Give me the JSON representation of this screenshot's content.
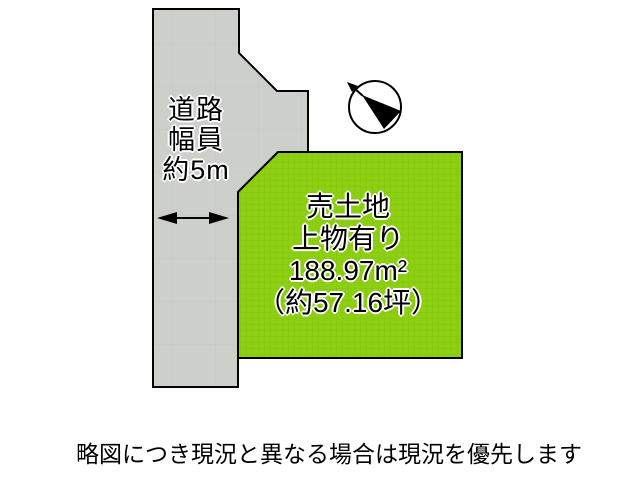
{
  "diagram": {
    "road": {
      "label_lines": [
        "道路",
        "幅員",
        "約5m"
      ],
      "width_arrow_icon": "double-headed-arrow-icon"
    },
    "parcel": {
      "title": "売土地",
      "subtitle": "上物有り",
      "area_sqm": "188.97m²",
      "area_tsubo": "（約57.16坪）"
    },
    "compass_icon": "compass-north-icon",
    "note": "略図につき現況と異なる場合は現況を優先します",
    "colors": {
      "road_fill": "#cdd0ca",
      "road_grid": "#c3c7c2",
      "parcel_fill": "#8dd012",
      "parcel_grid": "#83c50f",
      "outline": "#000000",
      "text": "#000000",
      "text_halo": "#ffffff",
      "background": "#ffffff"
    }
  }
}
